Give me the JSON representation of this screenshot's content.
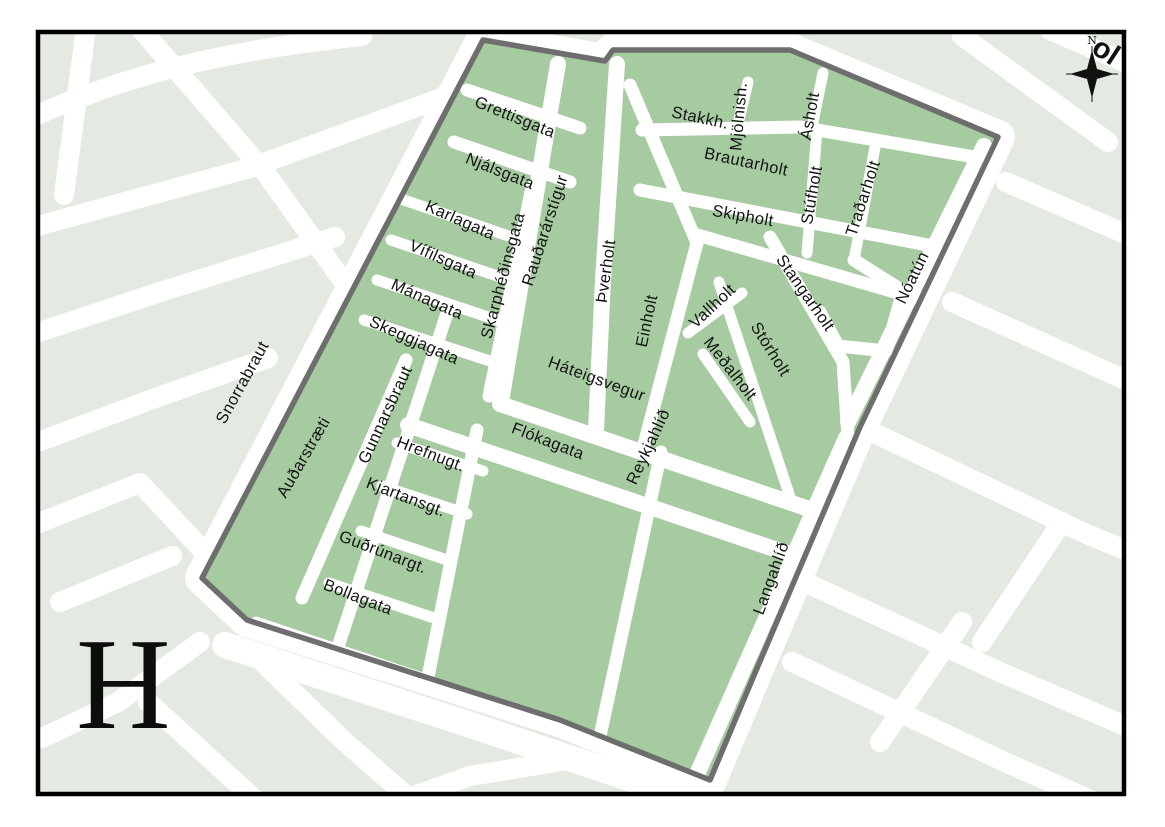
{
  "page": {
    "index_letter": "H",
    "compass": {
      "north_label": "N"
    },
    "corner_partial_label": "ol"
  },
  "colors": {
    "district_fill": "#a6cba0",
    "district_border": "#6e6e6e",
    "outside_block_fill": "#e4eae2",
    "street_fill": "#ffffff",
    "frame": "#000000",
    "label_color": "#141414"
  },
  "streets": {
    "labels": [
      "Grettisgata",
      "Njálsgata",
      "Karlagata",
      "Vífilsgata",
      "Mánagata",
      "Skeggjagata",
      "Snorrabraut",
      "Auðarstræti",
      "Gunnarsbraut",
      "Skarphéðinsgata",
      "Rauðarárstígur",
      "Þverholt",
      "Einholt",
      "Hrefnugt.",
      "Kjartansgt.",
      "Guðrúnargt.",
      "Bollagata",
      "Háteigsvegur",
      "Flókagata",
      "Reykjahlíð",
      "Langahlíð",
      "Stakkh.",
      "Mjölnish.",
      "Brautarholt",
      "Skipholt",
      "Ásholt",
      "Stúfholt",
      "Traðarholt",
      "Stangarholt",
      "Vallholt",
      "Meðalholt",
      "Stórholt",
      "Nóatún"
    ]
  }
}
